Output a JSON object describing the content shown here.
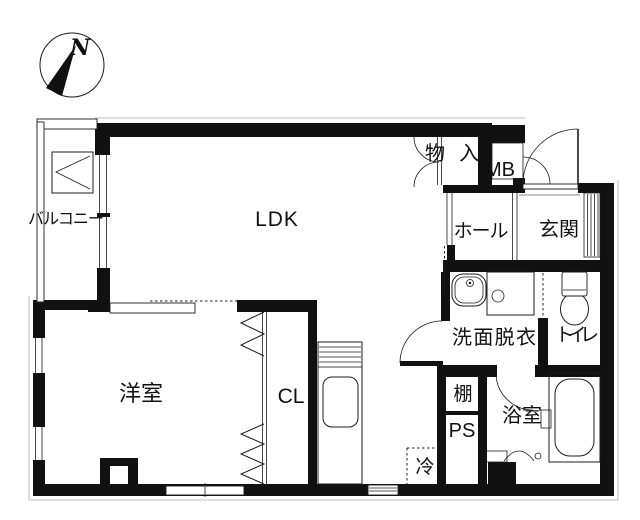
{
  "compass": {
    "north_label": "N"
  },
  "rooms": {
    "balcony": "バルコニー",
    "ldk": "LDK",
    "western_room": "洋室",
    "closet": "CL",
    "storage": "物入",
    "meter_box": "MB",
    "hall": "ホール",
    "entrance": "玄関",
    "washroom": "洗面脱衣",
    "toilet": "トイレ",
    "shelf": "棚",
    "pipe_space": "PS",
    "bathroom": "浴室",
    "refrigerator": "冷"
  },
  "colors": {
    "wall": "#111111",
    "line": "#1c1c1c",
    "background": "#ffffff"
  }
}
